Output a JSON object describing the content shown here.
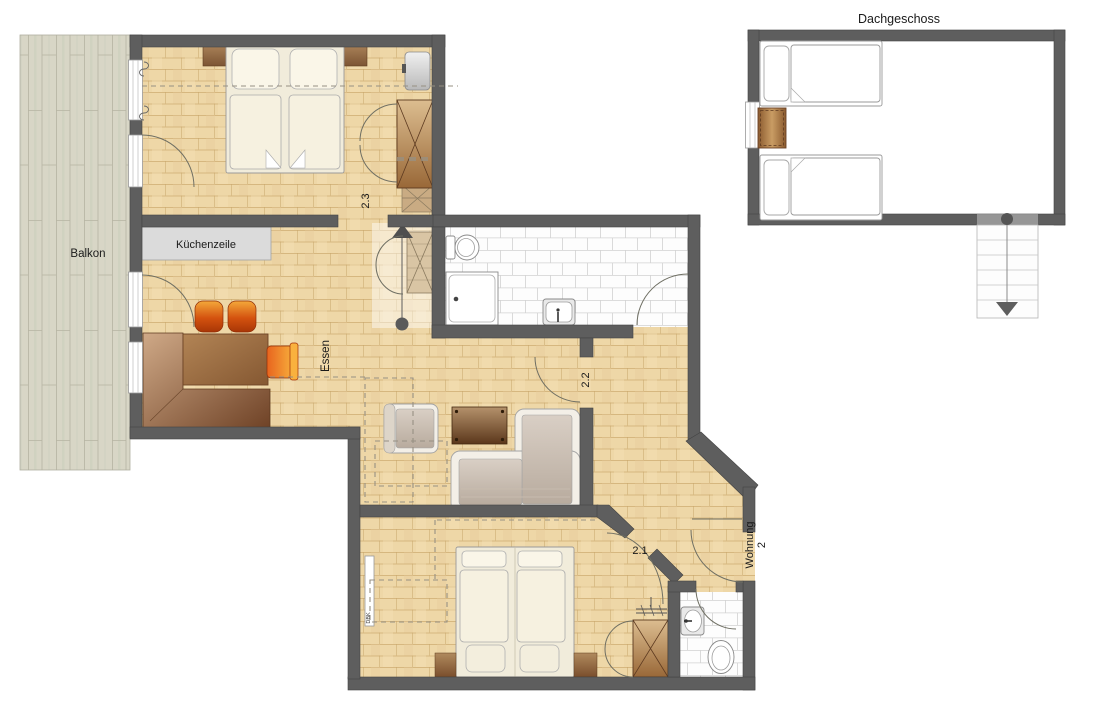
{
  "plan": {
    "balcony_label": "Balkon",
    "kitchen_label": "Küchenzeile",
    "dining_label": "Essen",
    "room_2_3": "2.3",
    "room_2_2": "2.2",
    "room_2_1": "2.1",
    "apartment_label_line1": "Wohnung",
    "apartment_label_line2": "2",
    "radiator_label": "DBK"
  },
  "attic": {
    "title": "Dachgeschoss"
  },
  "colors": {
    "wall": "#5e5e5e",
    "wall_edge": "#434343",
    "wood": "#eed7a7",
    "wood_line": "#c8a468",
    "tile": "#fdfdfd",
    "tile_line": "#d2d2d2",
    "deck": "#d8d6c6",
    "deck_line": "#b6b4a2",
    "brown_dark": "#6e4426",
    "brown_mid": "#a8784a",
    "brown_light": "#d9b98c",
    "orange": "#f0a030",
    "orange_dark": "#c03c10",
    "cream": "#f6f1e0",
    "fixture_line": "#8a8a8a",
    "door_arc": "#6f6f63",
    "dash_gray": "#979083"
  }
}
